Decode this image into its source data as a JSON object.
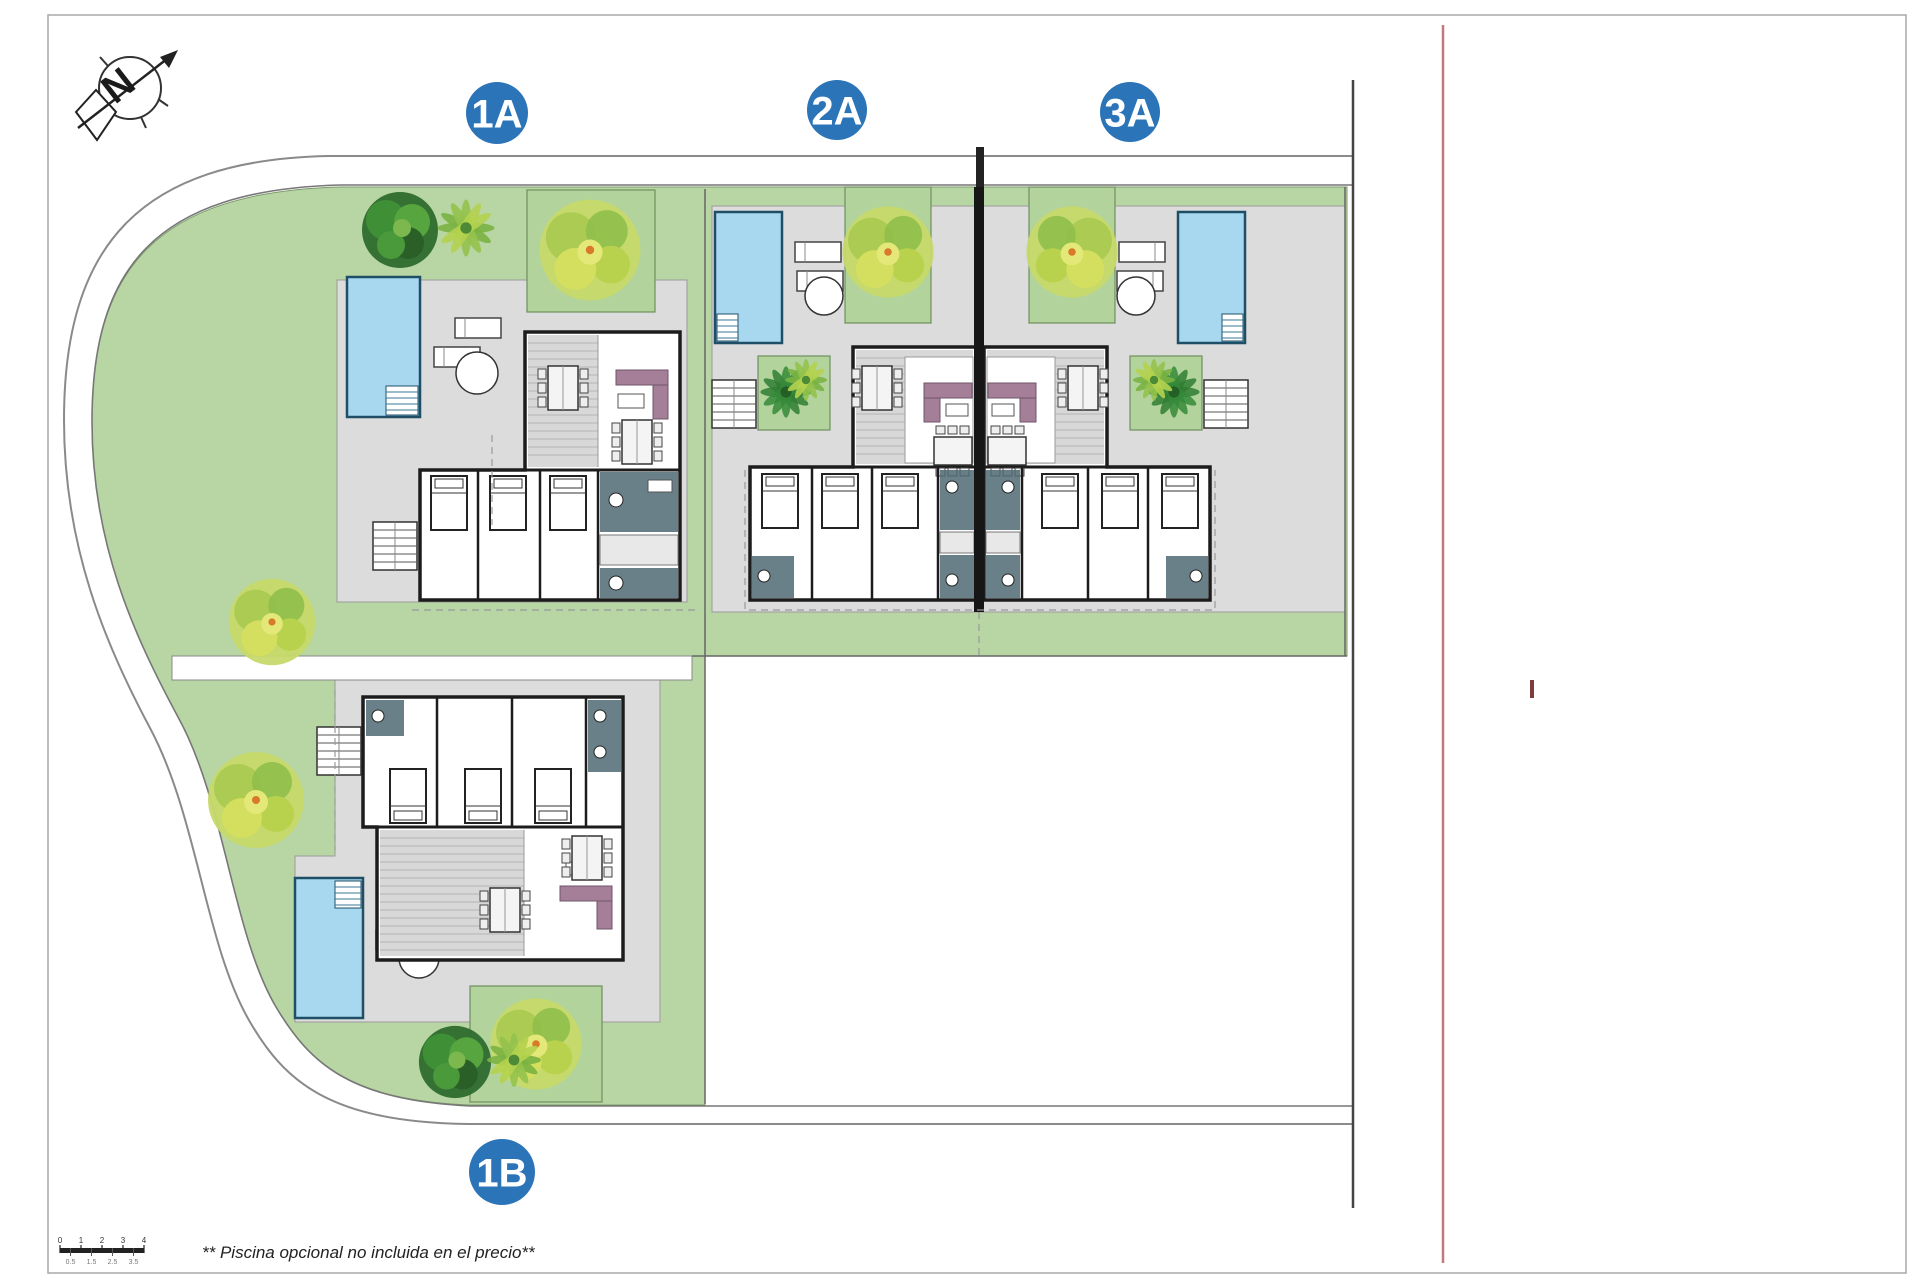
{
  "compass": {
    "label": "N"
  },
  "villas": [
    {
      "id": "villa-1a",
      "label": "1A"
    },
    {
      "id": "villa-2a",
      "label": "2A"
    },
    {
      "id": "villa-3a",
      "label": "3A"
    },
    {
      "id": "villa-1b",
      "label": "1B"
    }
  ],
  "document": {
    "note": "** Piscina opcional no incluida en el precio**"
  },
  "scale_bar": {
    "top_labels": [
      "0",
      "1",
      "2",
      "3",
      "4"
    ],
    "bottom_labels": [
      "0.5",
      "1.5",
      "2.5",
      "3.5"
    ]
  },
  "colors": {
    "badge_blue": "#2b74b8",
    "pool_blue": "#a8d8f0",
    "garden_green": "#b8d6a4",
    "paving_gray": "#dcdcdc",
    "sofa_purple": "#a57f97",
    "wall_black": "#1c1c1c",
    "red_reference_line": "#c4797b"
  }
}
